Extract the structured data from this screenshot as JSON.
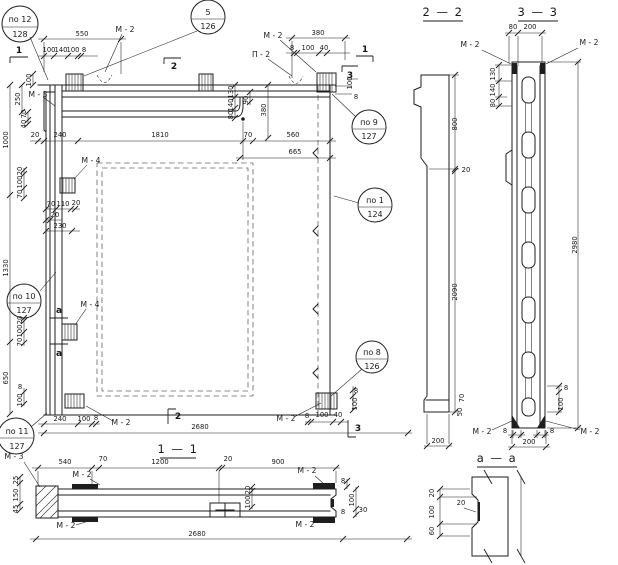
{
  "colors": {
    "ink": "#1e1e1e",
    "paper": "#ffffff"
  },
  "callouts": {
    "c12": {
      "line1": "по 12",
      "line2": "128"
    },
    "c5": {
      "line1": "5",
      "line2": "126"
    },
    "c9": {
      "line1": "по 9",
      "line2": "127"
    },
    "c1": {
      "line1": "по 1",
      "line2": "124"
    },
    "c8": {
      "line1": "по 8",
      "line2": "126"
    },
    "c10": {
      "line1": "по 10",
      "line2": "127"
    },
    "c11": {
      "line1": "по 11",
      "line2": "127"
    }
  },
  "marks": {
    "m2": "М - 2",
    "m3": "М - 3",
    "m4": "М - 4",
    "p2": "П - 2"
  },
  "sections": {
    "s11": "1 — 1",
    "s22": "2 — 2",
    "s33": "3 — 3",
    "saa": "а — а"
  },
  "flags": {
    "f1": "1",
    "f2": "2",
    "f3": "3",
    "fa": "а"
  },
  "dims": {
    "d8": "8",
    "d20": "20",
    "d25": "25",
    "d30": "30",
    "d40": "40",
    "d45": "45",
    "d50": "50",
    "d60": "60",
    "d70": "70",
    "d80": "80",
    "d90": "90",
    "d100": "100",
    "d110": "110",
    "d130": "130",
    "d140": "140",
    "d150": "150",
    "d200": "200",
    "d230": "230",
    "d240": "240",
    "d250": "250",
    "d380": "380",
    "d540": "540",
    "d550": "550",
    "d560": "560",
    "d650": "650",
    "d665": "665",
    "d800": "800",
    "d900": "900",
    "d1000": "1000",
    "d1200": "1200",
    "d1330": "1330",
    "d1810": "1810",
    "d2090": "2090",
    "d2680": "2680",
    "d2980": "2980"
  }
}
